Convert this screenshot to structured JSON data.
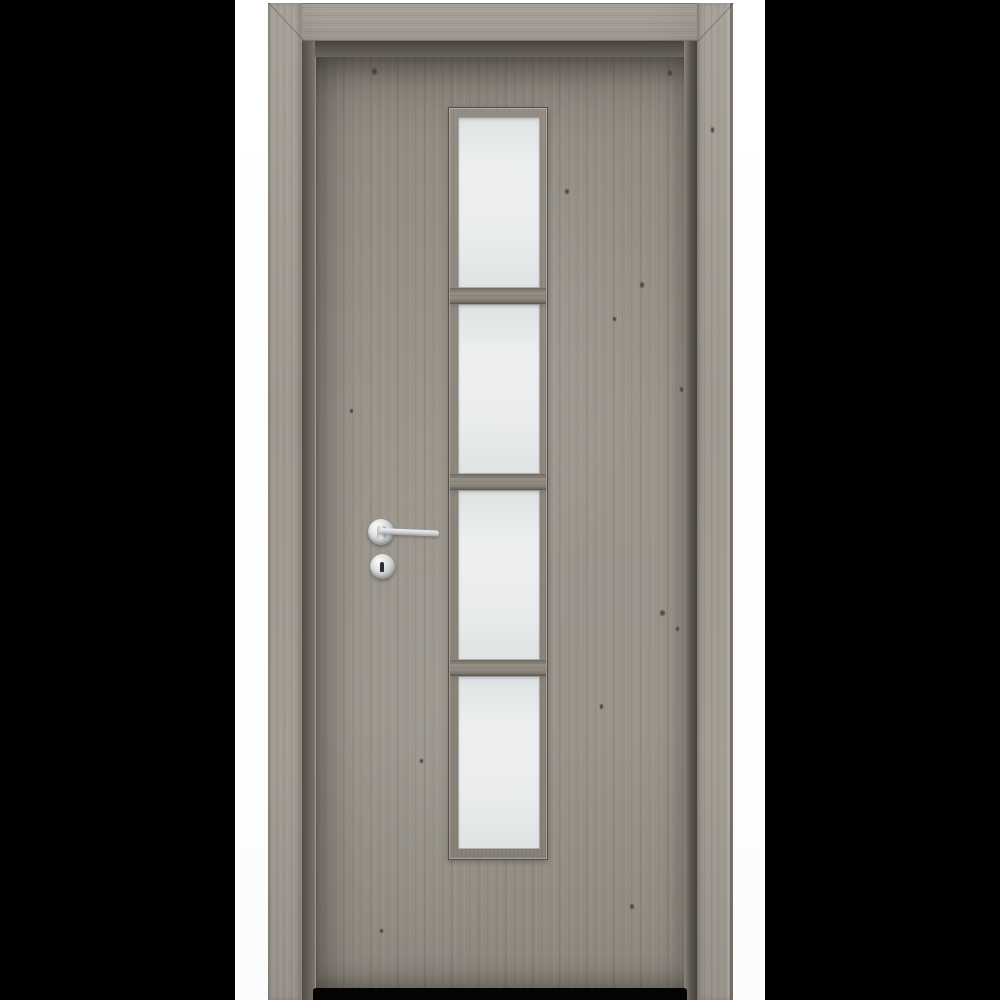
{
  "scene": {
    "type": "product-photo",
    "description": "Interior door with grey oak woodgrain finish, matching architrave frame, central vertical glazing strip of four frosted glass panes separated by three wooden mullions, chrome lever handle and round keyhole escutcheon, shown on white background with black side bars",
    "background_bars_color": "#000000",
    "photo_background_color": "#ffffff"
  },
  "door": {
    "style": "flush interior door with vertical glazing strip",
    "finish": "grey oak laminate (Siberian oak tone)",
    "glass_pane_count": 4,
    "mullion_count": 3,
    "hardware": [
      "chrome lever handle on round rosette",
      "round keyhole escutcheon"
    ],
    "frame": "matching grey oak architrave casing with mitered top corners"
  },
  "colors": {
    "casing_wood": "#a49e96",
    "leaf_wood": "#98928a",
    "leaf_shadow": "#6f6a63",
    "reveal_dark": "#524d47",
    "glass_light": "#edeff0",
    "glass_dark": "#dfe2e3",
    "bead_wood": "#8d877f",
    "mullion_wood": "#8d877e",
    "chrome_light": "#f0f1f2",
    "chrome_dark": "#9b9d9e",
    "keyhole": "#2f2d2b",
    "floor_gap": "#040404",
    "knot": "#3e372f"
  }
}
